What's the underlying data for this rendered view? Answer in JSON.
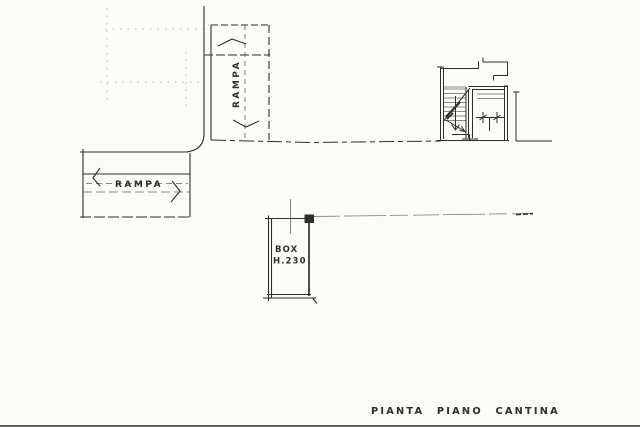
{
  "plan": {
    "title": "PIANTA PIANO CANTINA",
    "rooms": {
      "ramp_vertical": {
        "label": "RAMPA"
      },
      "ramp_horizontal": {
        "label": "RAMPA"
      },
      "box": {
        "label": "BOX",
        "height_note": "H.230"
      }
    },
    "colors": {
      "ink": "#2e2e2e",
      "paper": "#fbfbf8"
    }
  }
}
